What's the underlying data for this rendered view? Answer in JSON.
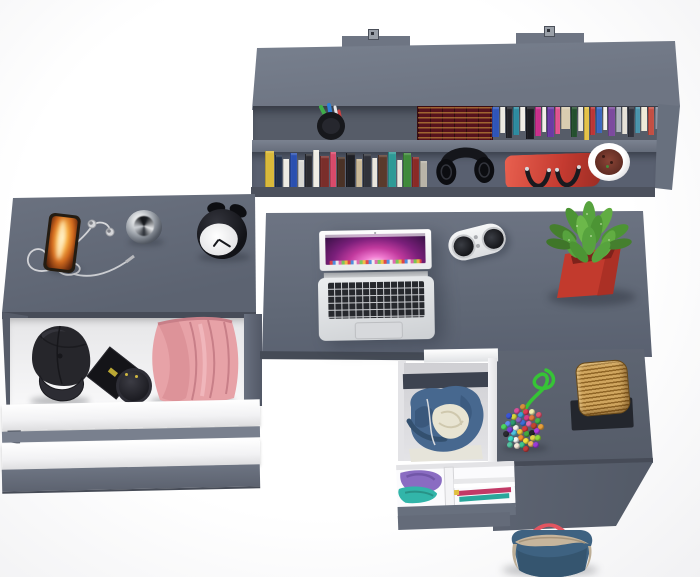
{
  "scene": {
    "title": "Top-down 3D render of a grey home-office desk set",
    "description": "Grey wall shelf with books above an L-shaped desk with open laptop; side drawer unit with open drawers holding a cap and pink clothes; centre drawer with a blue hoodie; succulent, speaker, basket, beaded pouch and tote bag"
  },
  "palette": {
    "bg": "#ffffff",
    "shelfTop": "#6e7583",
    "surface": "#646b79",
    "surfaceLight": "#78808e",
    "surfaceDark": "#565c68",
    "edge": "#474c58",
    "potRed": "#c23a2d",
    "leafGreen": "#57a33e",
    "bagRed": "#c43a30",
    "ropeGreen": "#36c436",
    "basketTan": "#c29a54",
    "denimBlue": "#3e6281",
    "hoodieBlue": "#456890",
    "creamLining": "#e8e4d2",
    "pinkClothes": "#e7a2a7",
    "capBlack": "#27272c",
    "purpleClothes": "#8a6cc2",
    "tealClothes": "#32b5a9"
  },
  "labels": {
    "shelf_unit": "Wall shelf with books",
    "mount": "Wall mount bracket",
    "pen_cup": "Pen cup with pens",
    "vintage_books": "Vintage books with gilded spines",
    "upper_books": "Row of books (upper shelf)",
    "lower_books": "Row of books (lower shelf)",
    "headphones": "Black headphones",
    "handbag": "Red handbag with black straps",
    "shelf_plant": "Plant in white pot",
    "desk": "Desk top",
    "laptop": "Open laptop",
    "laptop_screen": "Laptop screen with purple wallpaper",
    "keyboard": "Laptop keyboard",
    "trackpad": "Trackpad",
    "speaker": "White portable speaker",
    "succulent": "Succulent in red pot",
    "smartphone": "Smartphone with orange wallpaper",
    "earphones": "White earphones with tangled cable",
    "metal_jar": "Chrome jar",
    "alarm_clock": "Black alarm clock",
    "side_unit": "Side drawer unit",
    "open_drawer": "Open drawer",
    "cap": "Black cap",
    "gift_box": "Black box",
    "round_box": "Round black box",
    "pink_clothes": "Folded pink clothes",
    "drawer_front": "White drawer front",
    "hoodie": "Blue hoodie in open drawer",
    "organizer": "Drawer with folded purple and teal clothes",
    "bead_bag": "Multicoloured beaded pouch",
    "rope": "Green cord",
    "basket": "Wicker basket",
    "basket_stand": "Black stand",
    "tote_bag": "Blue tote bag with red straps",
    "return_desk": "Desk return surface",
    "return_panel": "Desk front panel"
  },
  "shelf": {
    "upper_books": [
      {
        "c": "#2f55b8",
        "w": 7,
        "h": 30
      },
      {
        "c": "#ece9e1",
        "w": 5,
        "h": 26
      },
      {
        "c": "#23242a",
        "w": 6,
        "h": 31
      },
      {
        "c": "#2d8ba0",
        "w": 6,
        "h": 28
      },
      {
        "c": "#f0ede6",
        "w": 4,
        "h": 24
      },
      {
        "c": "#1c1d23",
        "w": 8,
        "h": 32
      },
      {
        "c": "#c92f8c",
        "w": 6,
        "h": 29
      },
      {
        "c": "#f2efe8",
        "w": 4,
        "h": 25
      },
      {
        "c": "#6a3ba3",
        "w": 7,
        "h": 30
      },
      {
        "c": "#e0538f",
        "w": 5,
        "h": 27
      },
      {
        "c": "#d9cdb0",
        "w": 9,
        "h": 22
      },
      {
        "c": "#24502e",
        "w": 6,
        "h": 30
      },
      {
        "c": "#e9e6de",
        "w": 5,
        "h": 24
      },
      {
        "c": "#e3c247",
        "w": 4,
        "h": 33
      },
      {
        "c": "#bc3636",
        "w": 5,
        "h": 28
      },
      {
        "c": "#3a67bf",
        "w": 6,
        "h": 26
      },
      {
        "c": "#f4f1ea",
        "w": 4,
        "h": 23
      },
      {
        "c": "#7c4a9e",
        "w": 6,
        "h": 29
      },
      {
        "c": "#aab0ba",
        "w": 5,
        "h": 25
      },
      {
        "c": "#e6e2d8",
        "w": 5,
        "h": 27
      },
      {
        "c": "#30323c",
        "w": 6,
        "h": 30
      },
      {
        "c": "#4a94ac",
        "w": 5,
        "h": 26
      },
      {
        "c": "#efe9d8",
        "w": 6,
        "h": 24
      },
      {
        "c": "#c44f43",
        "w": 5,
        "h": 28
      },
      {
        "c": "#8b93a3",
        "w": 5,
        "h": 22
      }
    ],
    "lower_books": [
      {
        "c": "#d9b93a",
        "w": 8,
        "h": 36
      },
      {
        "c": "#22304a",
        "w": 7,
        "h": 32
      },
      {
        "c": "#edebe3",
        "w": 5,
        "h": 28
      },
      {
        "c": "#2a50b0",
        "w": 7,
        "h": 34
      },
      {
        "c": "#d8d8d4",
        "w": 5,
        "h": 27
      },
      {
        "c": "#2a2b31",
        "w": 6,
        "h": 33
      },
      {
        "c": "#f0ede5",
        "w": 6,
        "h": 37
      },
      {
        "c": "#7a2e2a",
        "w": 8,
        "h": 31
      },
      {
        "c": "#d84a6a",
        "w": 6,
        "h": 35
      },
      {
        "c": "#4a3226",
        "w": 7,
        "h": 30
      },
      {
        "c": "#1e1f24",
        "w": 8,
        "h": 34
      },
      {
        "c": "#c9b897",
        "w": 6,
        "h": 28
      },
      {
        "c": "#30323a",
        "w": 7,
        "h": 33
      },
      {
        "c": "#e9e6de",
        "w": 5,
        "h": 29
      },
      {
        "c": "#5a3a2c",
        "w": 8,
        "h": 32
      },
      {
        "c": "#2e9a96",
        "w": 7,
        "h": 35
      },
      {
        "c": "#eae7df",
        "w": 5,
        "h": 27
      },
      {
        "c": "#3f8a3a",
        "w": 7,
        "h": 34
      },
      {
        "c": "#8a2a26",
        "w": 7,
        "h": 30
      },
      {
        "c": "#b9b4a8",
        "w": 6,
        "h": 26
      }
    ]
  },
  "bead_colors": [
    "#d63b3b",
    "#f2c53d",
    "#3b6fd6",
    "#43a83e",
    "#f5f0ea",
    "#e06ab0",
    "#f08a2e",
    "#8a5fc2",
    "#23242a",
    "#4ec3e0",
    "#d63b8a",
    "#f2e03d",
    "#2e9a6e",
    "#c2452e",
    "#f5f5f5",
    "#3b9fd6",
    "#e0d04a",
    "#7a3bd6",
    "#e07a3b",
    "#3ec48f",
    "#d6d63b",
    "#b03be0",
    "#3bd6c2",
    "#e03b55",
    "#f0b65f",
    "#5f8af0",
    "#46b446",
    "#f5e9d9",
    "#d64f9a",
    "#8fd63e",
    "#2a2b31",
    "#f0f0b0",
    "#c23b3b",
    "#3b55d6",
    "#e8a03b",
    "#55c2a0",
    "#d68f3b",
    "#9a3bd6",
    "#4ad65f",
    "#e05570"
  ]
}
